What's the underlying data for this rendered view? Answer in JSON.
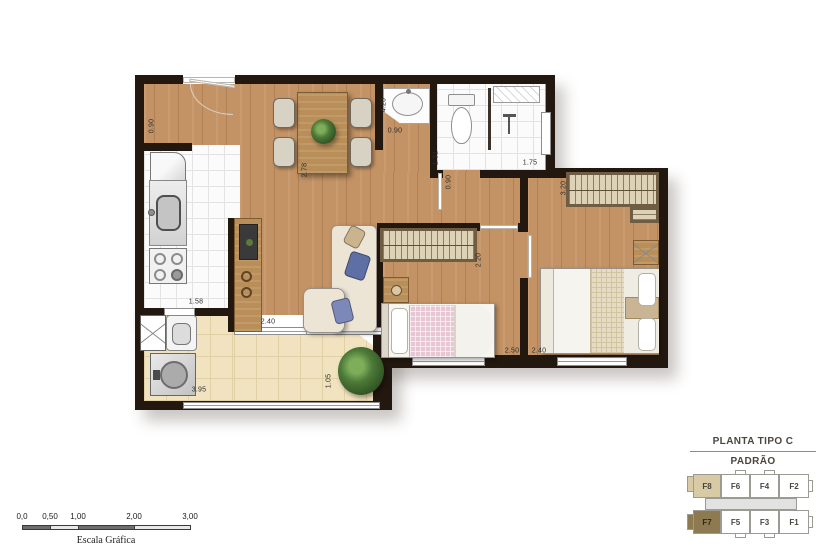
{
  "plan": {
    "dimensions": [
      {
        "id": "entry-width",
        "value": "0.90"
      },
      {
        "id": "kitchen-depth",
        "value": "2.78"
      },
      {
        "id": "dining-depth",
        "value": "4.20"
      },
      {
        "id": "lavatory-width",
        "value": "0.90"
      },
      {
        "id": "bathroom-width",
        "value": "1.31"
      },
      {
        "id": "shower-width",
        "value": "1.75"
      },
      {
        "id": "hall-width",
        "value": "0.90"
      },
      {
        "id": "wardrobe-length",
        "value": "3.20"
      },
      {
        "id": "bedroom1-wardrobe",
        "value": "2.20"
      },
      {
        "id": "living-width",
        "value": "2.40"
      },
      {
        "id": "kitchen-width",
        "value": "1.58"
      },
      {
        "id": "balcony-width",
        "value": "3.95"
      },
      {
        "id": "balcony-depth",
        "value": "1.05"
      },
      {
        "id": "bedroom1-width",
        "value": "2.50"
      },
      {
        "id": "bedroom2-width",
        "value": "2.40"
      }
    ]
  },
  "legend": {
    "title": "PLANTA TIPO C",
    "subtitle": "PADRÃO",
    "units_top": [
      {
        "label": "F8",
        "highlighted": true
      },
      {
        "label": "F6"
      },
      {
        "label": "F4"
      },
      {
        "label": "F2"
      }
    ],
    "units_bottom": [
      {
        "label": "F7",
        "highlighted": true
      },
      {
        "label": "F5"
      },
      {
        "label": "F3"
      },
      {
        "label": "F1"
      }
    ],
    "highlight_colors": {
      "f8": "#d8caa4",
      "f7": "#8d7a50"
    }
  },
  "scale_bar": {
    "ticks": [
      "0,0",
      "0,50",
      "1,00",
      "2,00",
      "3,00"
    ],
    "caption": "Escala Gráfica"
  },
  "colors": {
    "wall": "#231810",
    "wood_floor": "#c49365",
    "white_tile": "#fbfbfb",
    "balcony_tile": "#f1e2c0",
    "legend_divider": "#9a914c"
  }
}
